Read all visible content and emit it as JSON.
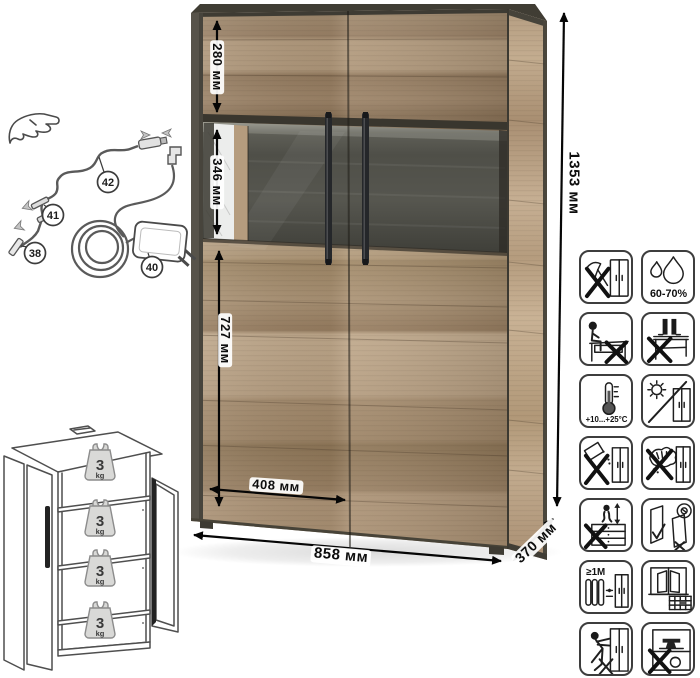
{
  "dimensions": {
    "top_section": "280 мм",
    "glass_section": "346 мм",
    "bottom_section": "727 мм",
    "door_width": "408 мм",
    "width": "858 мм",
    "depth": "370 мм",
    "height": "1353 мм"
  },
  "callouts": {
    "n38": "38",
    "n40": "40",
    "n41": "41",
    "n42": "42"
  },
  "shelf_load": {
    "value": "3",
    "unit": "kg"
  },
  "care_icons": [
    {
      "name": "no-sharp-tools"
    },
    {
      "name": "humidity-range",
      "label": "60-70%"
    },
    {
      "name": "no-sitting"
    },
    {
      "name": "no-standing"
    },
    {
      "name": "temperature-range",
      "label": "+10...+25°C"
    },
    {
      "name": "no-direct-sunlight"
    },
    {
      "name": "no-spilling"
    },
    {
      "name": "no-wet-cloth"
    },
    {
      "name": "no-jumping"
    },
    {
      "name": "door-adjustment"
    },
    {
      "name": "radiator-distance",
      "label": "≥1M"
    },
    {
      "name": "window-ventilation"
    },
    {
      "name": "no-dragging"
    },
    {
      "name": "no-overloading"
    }
  ],
  "colors": {
    "wood_light": "#b79f82",
    "wood_mid": "#a18968",
    "wood_dark": "#8f7758",
    "frame_dark": "#4e4a40",
    "glass_back": "#53534d",
    "handle": "#25272a"
  }
}
